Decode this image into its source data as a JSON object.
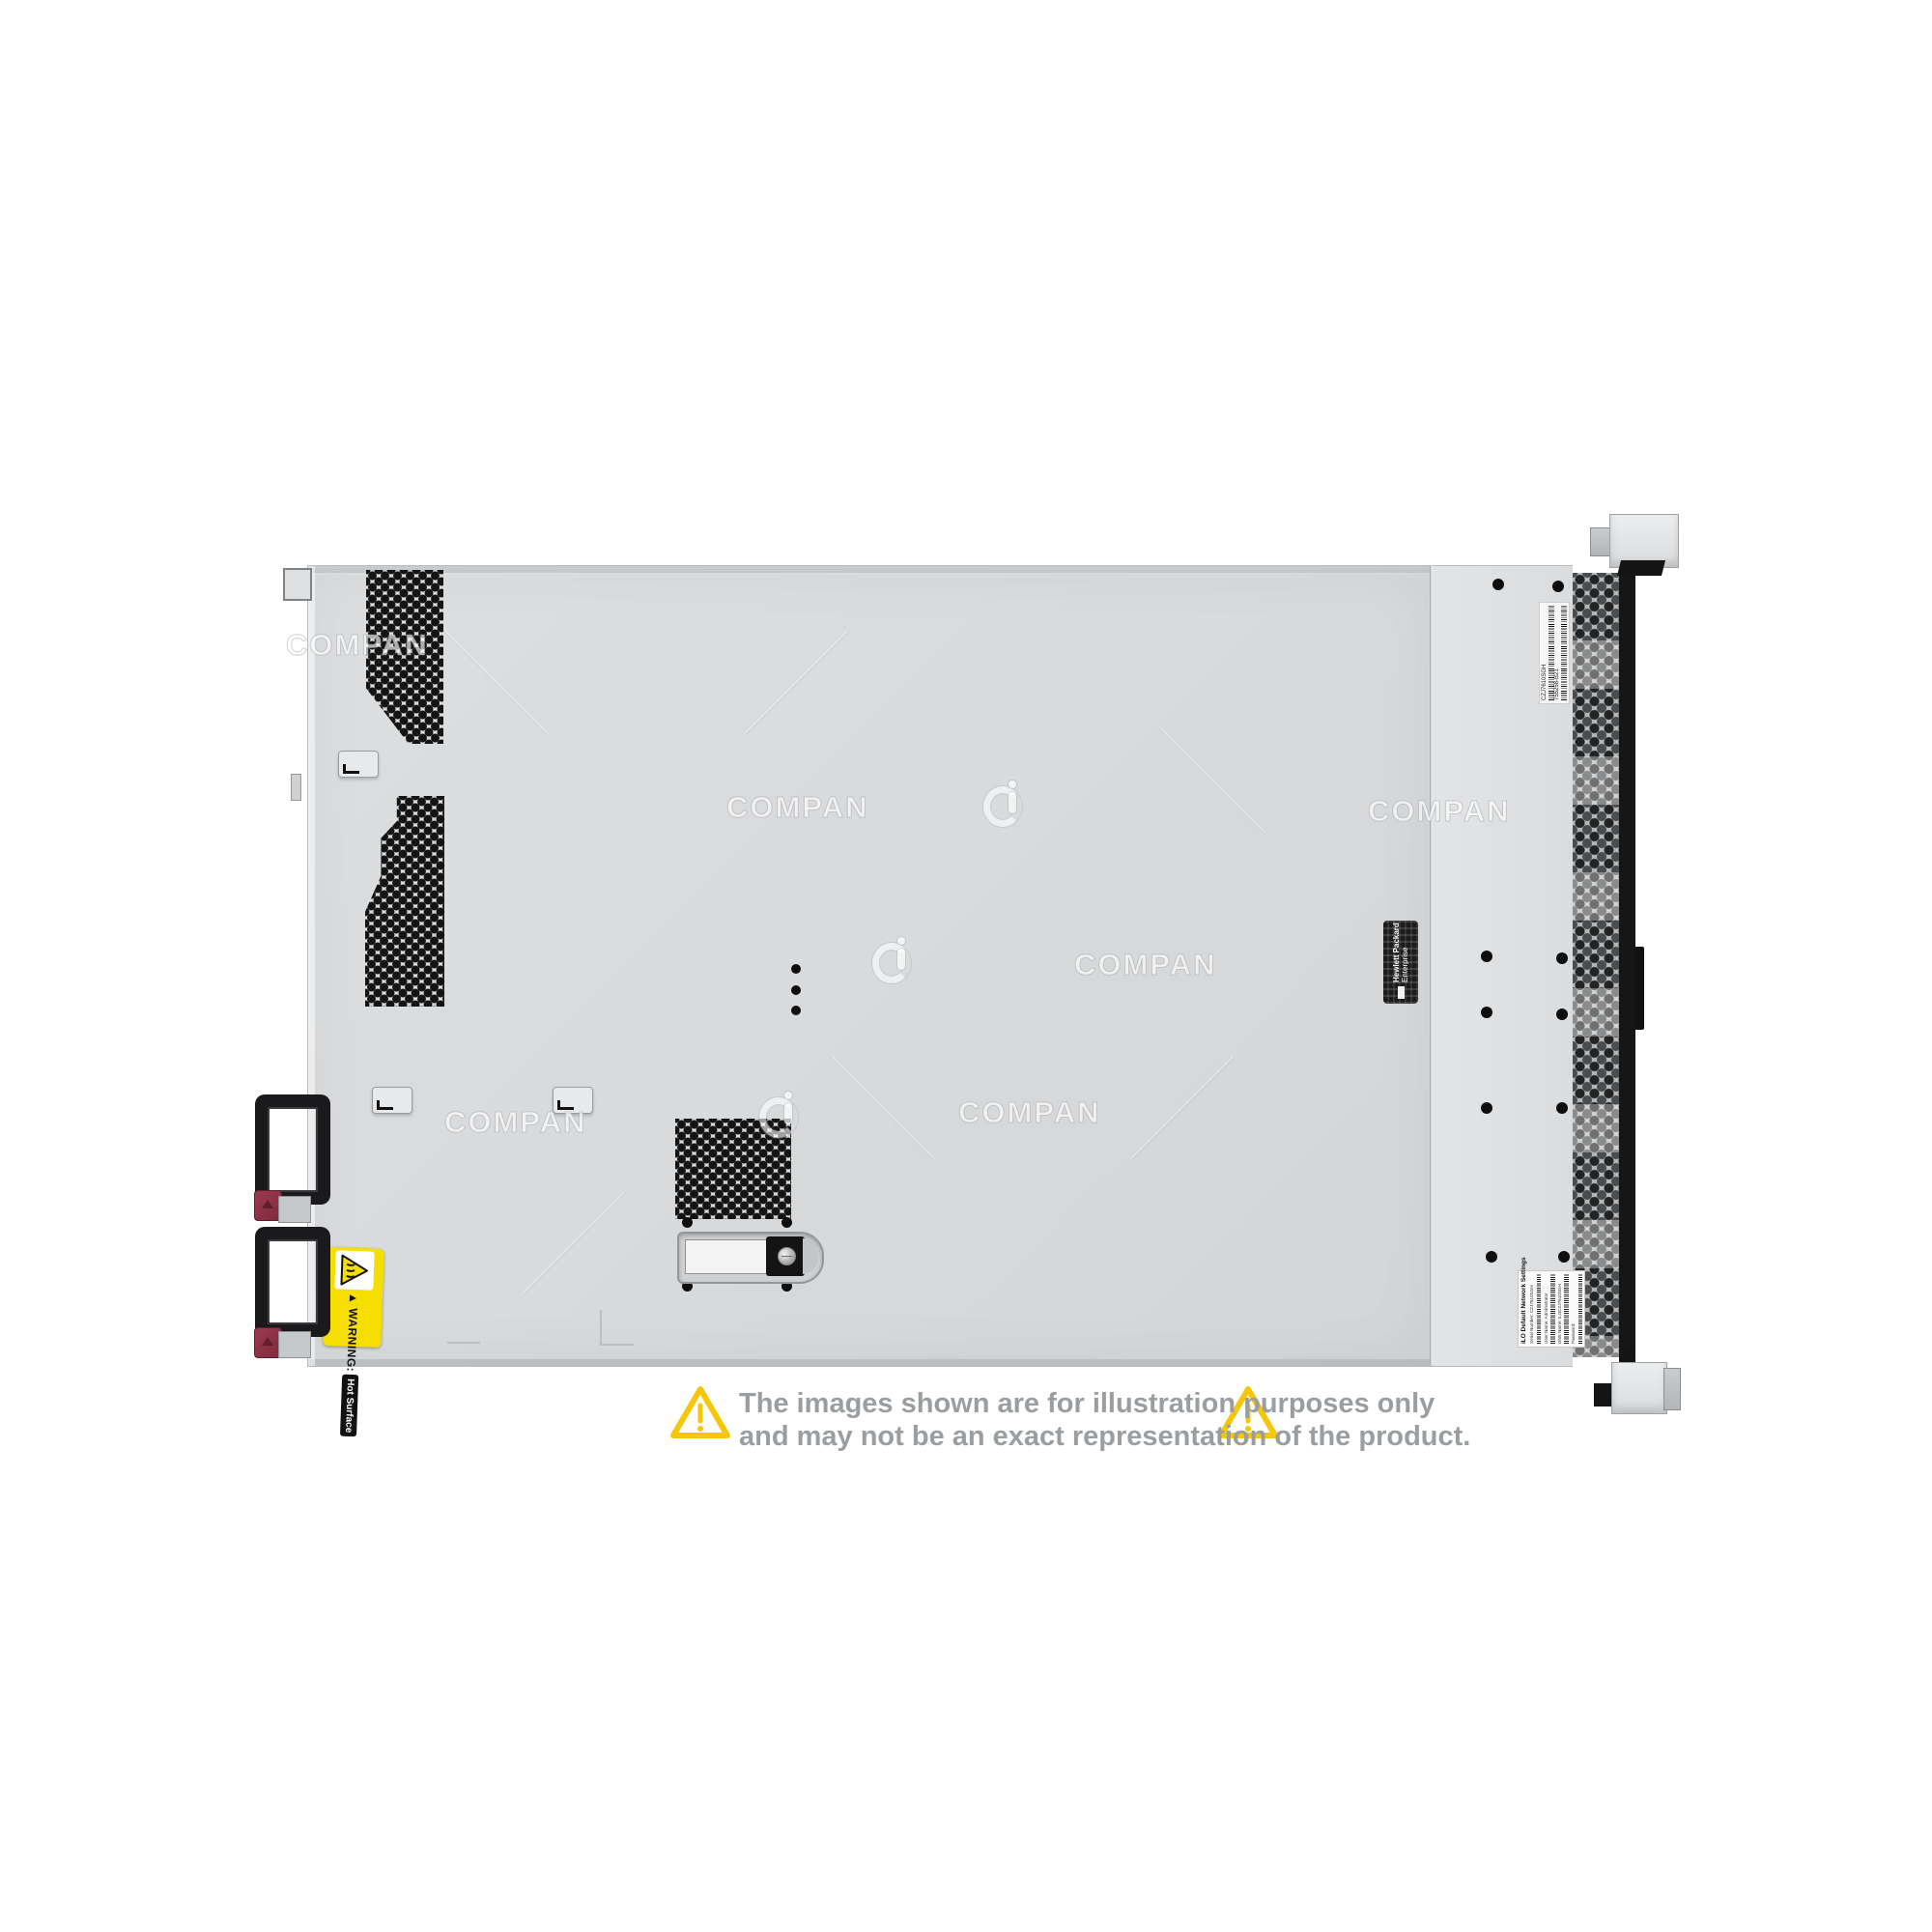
{
  "image": {
    "kind": "product-photo",
    "background_color": "#ffffff",
    "chassis_color": "#d8dadc"
  },
  "watermark": {
    "text": "COMPAN",
    "logo": "ci-circle-logo"
  },
  "labels": {
    "warning": {
      "title": "WARNING:",
      "subtitle": "Hot Surface",
      "bg_color": "#f6de00",
      "icon": "hot-surface-triangle"
    },
    "hpe": {
      "line1": "Hewlett Packard",
      "line2": "Enterprise",
      "bg_color": "#1c1c1c"
    },
    "serial": {
      "line1": "CZJ7610SGH",
      "line2": "755258-B21"
    },
    "ilo": {
      "title": "iLO Default Network Settings",
      "lines": [
        "Serial Number: CZJ7610SGH",
        "User Name: Administrator",
        "DNS Name: ILOCZJ7610SGH",
        "Password:"
      ]
    }
  },
  "disclaimer": {
    "line1": "The images shown are for illustration purposes only",
    "line2": "and may not be an exact representation of the product.",
    "text_color": "#9b9ea0",
    "triangle_color": "#f5c60a"
  }
}
